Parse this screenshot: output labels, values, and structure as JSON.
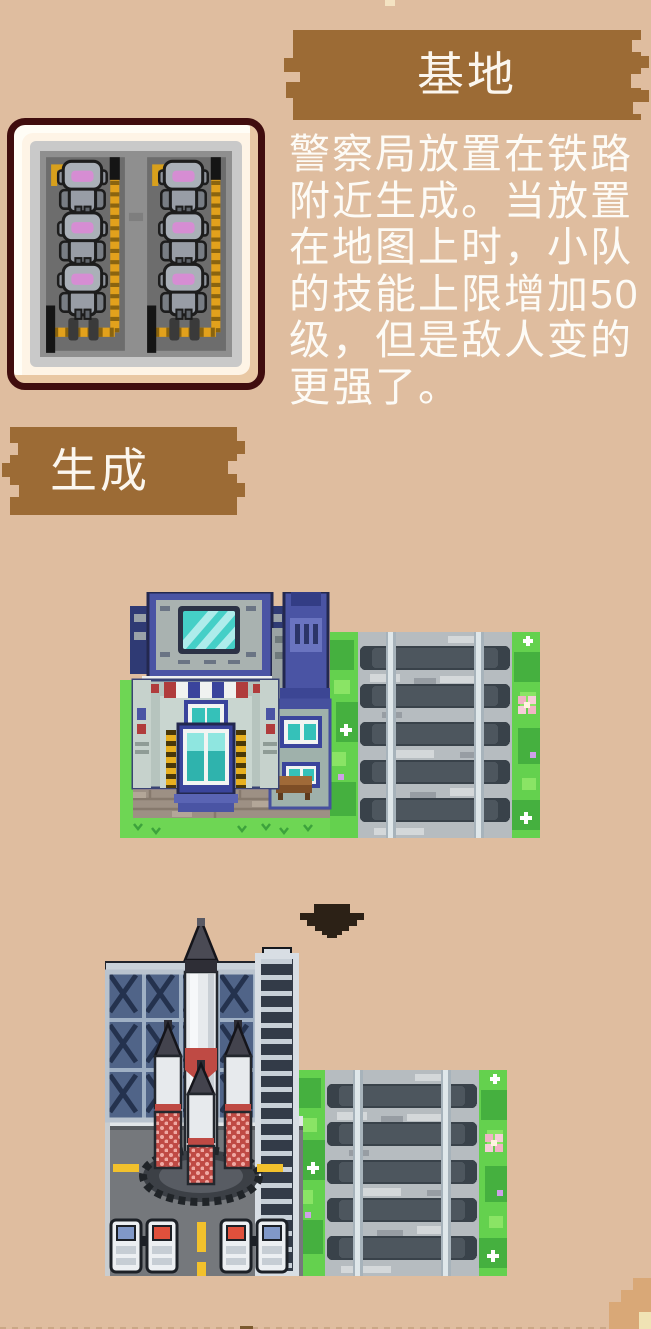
{
  "base_panel": {
    "title": "基地",
    "description": "警察局放置在铁路附近生成。当放置在地图上时，小队的技能上限增加50级，但是敌人变的更强了。"
  },
  "spawn_panel": {
    "title": "生成"
  },
  "sprites": {
    "preview": "stacked-police-robots",
    "before_scene": "police-station-beside-railroad",
    "transform_icon": "pixel-down-arrow",
    "after_scene": "rocket-launchpad-beside-railroad"
  },
  "colors": {
    "background": "#dfbd9f",
    "banner": "#9c6b35",
    "banner_text": "#fbf6ee",
    "body_text": "#fdfbf6",
    "frame_border": "#400d0e",
    "grass": "#64d14e",
    "rail_tie": "#4d565e",
    "hazard_yellow": "#e2a11c",
    "booster_red": "#bf4a44"
  }
}
